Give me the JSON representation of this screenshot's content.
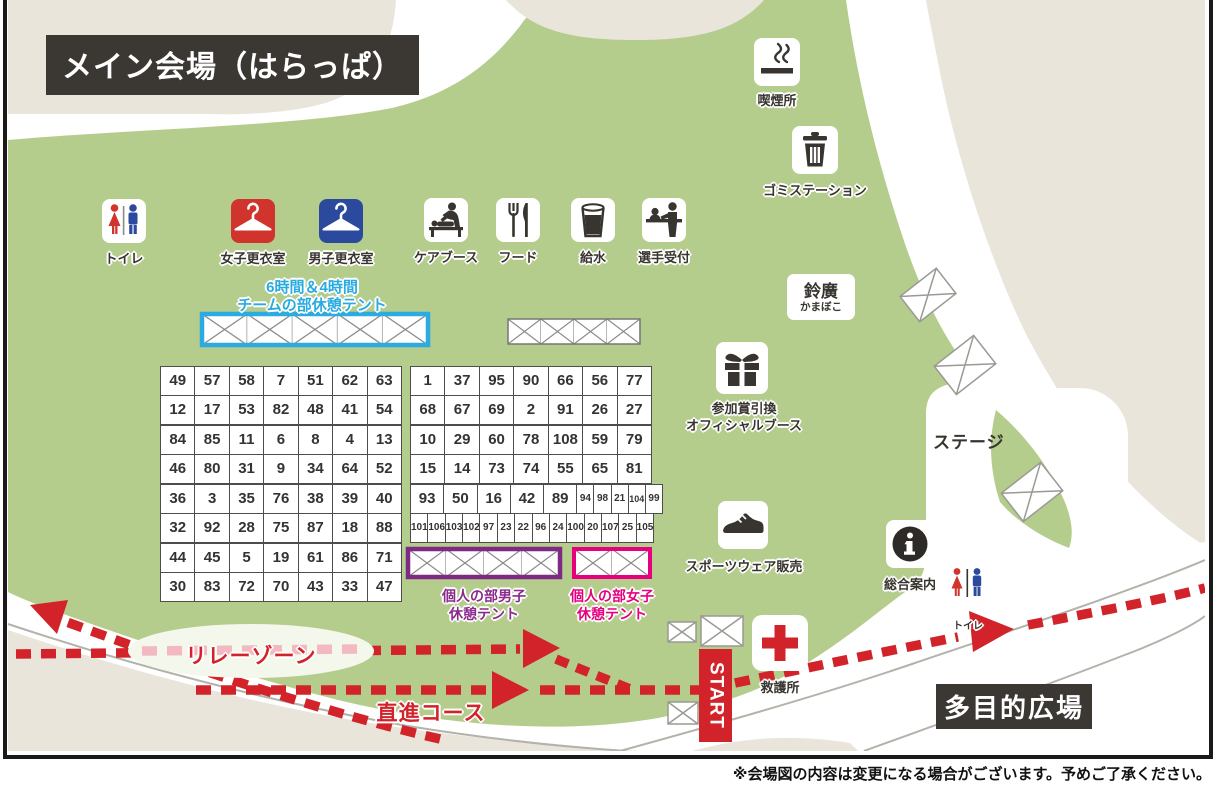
{
  "title": "メイン会場（はらっぱ）",
  "footnote": "※会場図の内容は変更になる場合がございます。予めご了承ください。",
  "colors": {
    "grass_green": "#b5cd8c",
    "path_beige": "#e9e5db",
    "course_red": "#d2232a",
    "team_tent_cyan": "#29abe2",
    "men_tent_purple": "#7e2a84",
    "women_tent_pink": "#e6007e",
    "dark_box": "#3b3733",
    "women_icon_red": "#d0342c",
    "men_icon_blue": "#2b4a9e"
  },
  "facilities": {
    "toilet": "トイレ",
    "women_changing": "女子更衣室",
    "men_changing": "男子更衣室",
    "care_booth": "ケアブース",
    "food": "フード",
    "water": "給水",
    "athlete_reception": "選手受付",
    "smoking_area": "喫煙所",
    "garbage_station": "ゴミステーション",
    "prize_line1": "参加賞引換",
    "prize_line2": "オフィシャルブース",
    "sportswear": "スポーツウェア販売",
    "information": "総合案内",
    "toilet_small": "トイレ",
    "first_aid": "救護所",
    "suzuhiro_line1": "鈴廣",
    "suzuhiro_line2": "かまぼこ"
  },
  "areas": {
    "stage": "ステージ",
    "multipurpose_plaza": "多目的広場"
  },
  "course": {
    "relay_zone": "リレーゾーン",
    "straight_course": "直進コース",
    "start": "START"
  },
  "tents": {
    "team_line1": "6時間＆4時間",
    "team_line2": "チームの部休憩テント",
    "men_line1": "個人の部男子",
    "men_line2": "休憩テント",
    "women_line1": "個人の部女子",
    "women_line2": "休憩テント"
  },
  "tent_numbers": {
    "left_blocks": [
      {
        "rows": [
          [
            49,
            57,
            58,
            7,
            51,
            62,
            63
          ],
          [
            12,
            17,
            53,
            82,
            48,
            41,
            54
          ]
        ]
      },
      {
        "rows": [
          [
            84,
            85,
            11,
            6,
            8,
            4,
            13
          ],
          [
            46,
            80,
            31,
            9,
            34,
            64,
            52
          ]
        ]
      },
      {
        "rows": [
          [
            36,
            3,
            35,
            76,
            38,
            39,
            40
          ],
          [
            32,
            92,
            28,
            75,
            87,
            18,
            88
          ]
        ]
      },
      {
        "rows": [
          [
            44,
            45,
            5,
            19,
            61,
            86,
            71
          ],
          [
            30,
            83,
            72,
            70,
            43,
            33,
            47
          ]
        ]
      }
    ],
    "right_blocks": [
      {
        "rows": [
          [
            1,
            37,
            95,
            90,
            66,
            56,
            77
          ],
          [
            68,
            67,
            69,
            2,
            91,
            26,
            27
          ]
        ]
      },
      {
        "rows": [
          [
            10,
            29,
            60,
            78,
            108,
            59,
            79
          ],
          [
            15,
            14,
            73,
            74,
            55,
            65,
            81
          ]
        ]
      }
    ],
    "mixed_block": {
      "rows": [
        {
          "w": 251,
          "cells": [
            {
              "v": 93,
              "s": 2
            },
            {
              "v": 50,
              "s": 2
            },
            {
              "v": 16,
              "s": 2
            },
            {
              "v": 42,
              "s": 2
            },
            {
              "v": 89,
              "s": 2
            },
            {
              "v": 94,
              "s": 1,
              "f": 10
            },
            {
              "v": 98,
              "s": 1,
              "f": 10
            },
            {
              "v": 21,
              "s": 1,
              "f": 10
            },
            {
              "v": 104,
              "s": 1,
              "f": 9
            },
            {
              "v": 99,
              "s": 1,
              "f": 10
            }
          ]
        },
        {
          "w": 242,
          "f": 10,
          "cells": [
            101,
            106,
            103,
            102,
            97,
            23,
            22,
            96,
            24,
            100,
            20,
            107,
            25,
            105
          ]
        }
      ]
    }
  }
}
